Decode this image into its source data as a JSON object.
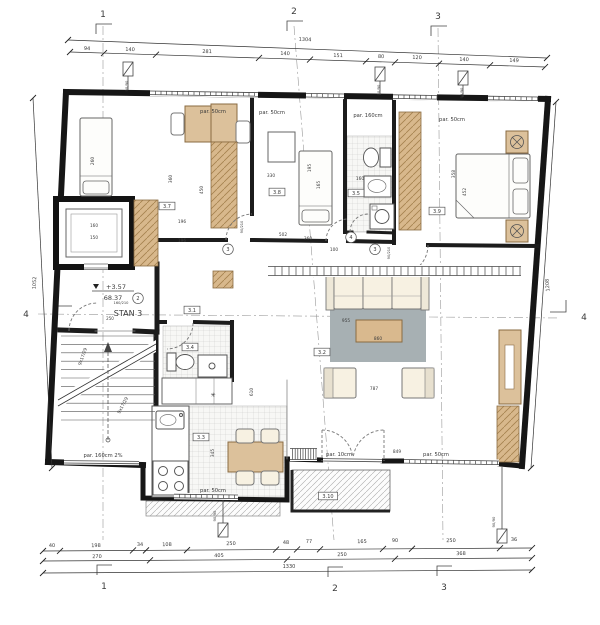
{
  "apartment": {
    "name": "STAN 3",
    "level": "+3.57",
    "area": "68.37"
  },
  "axes": {
    "top": [
      "1",
      "2",
      "3"
    ],
    "bottom": [
      "1",
      "2",
      "3"
    ],
    "left": "4",
    "right": "4"
  },
  "dimensions": {
    "top_total": "1304",
    "top_row": [
      "94",
      "140",
      "281",
      "140",
      "151",
      "80",
      "120",
      "140",
      "149"
    ],
    "bottom_row1": [
      "40",
      "198",
      "34",
      "108",
      "250",
      "48",
      "77",
      "165",
      "90",
      "250",
      "36"
    ],
    "bottom_row2": [
      "270",
      "405",
      "250",
      "368"
    ],
    "bottom_total": "1330",
    "left_total": "1052",
    "right_total": "1208"
  },
  "window_labels": [
    "par. 50cm",
    "par. 50cm",
    "par. 160cm",
    "par. 50cm",
    "par. 50cm",
    "par. 10cm",
    "par. 50cm",
    "par. 160cm 2%"
  ],
  "room_tags": [
    "3.1",
    "3.2",
    "3.3",
    "3.4",
    "3.5",
    "3.7",
    "3.8",
    "3.9",
    "3.10"
  ],
  "door_numbers": [
    "2",
    "3",
    "4",
    "3"
  ],
  "stair_label": "9x17/29",
  "labels": [
    {
      "n": "grid-axis-top-1",
      "t": "1",
      "x": 103,
      "y": 17,
      "s": 9,
      "c": "#222"
    },
    {
      "n": "grid-axis-top-2",
      "t": "2",
      "x": 294,
      "y": 14,
      "s": 9,
      "c": "#222"
    },
    {
      "n": "grid-axis-top-3",
      "t": "3",
      "x": 438,
      "y": 19,
      "s": 9,
      "c": "#222"
    },
    {
      "n": "grid-axis-bottom-1",
      "t": "1",
      "x": 104,
      "y": 589,
      "s": 9,
      "c": "#222"
    },
    {
      "n": "grid-axis-bottom-2",
      "t": "2",
      "x": 335,
      "y": 591,
      "s": 9,
      "c": "#222"
    },
    {
      "n": "grid-axis-bottom-3",
      "t": "3",
      "x": 444,
      "y": 590,
      "s": 9,
      "c": "#222"
    },
    {
      "n": "grid-axis-left-4",
      "t": "4",
      "x": 26,
      "y": 317,
      "s": 9,
      "c": "#222"
    },
    {
      "n": "grid-axis-right-4",
      "t": "4",
      "x": 584,
      "y": 320,
      "s": 9,
      "c": "#222"
    },
    {
      "n": "dim-top-total",
      "t": "1304",
      "x": 305,
      "y": 41,
      "r": 2
    },
    {
      "n": "dim-bottom-total",
      "t": "1330",
      "x": 289,
      "y": 568
    },
    {
      "n": "dim-left-total",
      "t": "1052",
      "x": 36,
      "y": 283,
      "r": -87
    },
    {
      "n": "dim-right-total",
      "t": "1208",
      "x": 549,
      "y": 285,
      "r": -94
    },
    {
      "n": "dim-top",
      "t": "94",
      "x": 87,
      "y": 50,
      "r": 2
    },
    {
      "n": "dim-top",
      "t": "140",
      "x": 130,
      "y": 51,
      "r": 2
    },
    {
      "n": "dim-top",
      "t": "281",
      "x": 207,
      "y": 53,
      "r": 2
    },
    {
      "n": "dim-top",
      "t": "140",
      "x": 285,
      "y": 55,
      "r": 2
    },
    {
      "n": "dim-top",
      "t": "151",
      "x": 338,
      "y": 57,
      "r": 2
    },
    {
      "n": "dim-top",
      "t": "80",
      "x": 381,
      "y": 58,
      "r": 2
    },
    {
      "n": "dim-top",
      "t": "120",
      "x": 417,
      "y": 59,
      "r": 2
    },
    {
      "n": "dim-top",
      "t": "140",
      "x": 464,
      "y": 61,
      "r": 2
    },
    {
      "n": "dim-top",
      "t": "149",
      "x": 514,
      "y": 62,
      "r": 2
    },
    {
      "n": "dim-bottom",
      "t": "40",
      "x": 52,
      "y": 547,
      "r": -1
    },
    {
      "n": "dim-bottom",
      "t": "198",
      "x": 96,
      "y": 547,
      "r": -1
    },
    {
      "n": "dim-bottom",
      "t": "34",
      "x": 140,
      "y": 546,
      "r": -1
    },
    {
      "n": "dim-bottom",
      "t": "108",
      "x": 167,
      "y": 546,
      "r": -1
    },
    {
      "n": "dim-bottom",
      "t": "250",
      "x": 231,
      "y": 545,
      "r": -1
    },
    {
      "n": "dim-bottom",
      "t": "48",
      "x": 286,
      "y": 544,
      "r": -1
    },
    {
      "n": "dim-bottom",
      "t": "77",
      "x": 309,
      "y": 543,
      "r": -1
    },
    {
      "n": "dim-bottom",
      "t": "165",
      "x": 362,
      "y": 543,
      "r": -1
    },
    {
      "n": "dim-bottom",
      "t": "90",
      "x": 395,
      "y": 542,
      "r": -1
    },
    {
      "n": "dim-bottom",
      "t": "250",
      "x": 451,
      "y": 542,
      "r": -1
    },
    {
      "n": "dim-bottom",
      "t": "36",
      "x": 514,
      "y": 541,
      "r": -1
    },
    {
      "n": "dim-bottom2",
      "t": "270",
      "x": 97,
      "y": 558,
      "r": -1
    },
    {
      "n": "dim-bottom2",
      "t": "405",
      "x": 219,
      "y": 557,
      "r": -1
    },
    {
      "n": "dim-bottom2",
      "t": "250",
      "x": 342,
      "y": 556,
      "r": -1
    },
    {
      "n": "dim-bottom2",
      "t": "368",
      "x": 461,
      "y": 555,
      "r": -1
    },
    {
      "n": "window-label",
      "t": "par. 50cm",
      "x": 213,
      "y": 113,
      "s": 5.2,
      "c": "#333"
    },
    {
      "n": "window-label",
      "t": "par. 50cm",
      "x": 272,
      "y": 114,
      "s": 5.2,
      "c": "#333"
    },
    {
      "n": "window-label",
      "t": "par. 160cm",
      "x": 368,
      "y": 117,
      "s": 5.2,
      "c": "#333"
    },
    {
      "n": "window-label",
      "t": "par. 50cm",
      "x": 452,
      "y": 121,
      "s": 5.2,
      "c": "#333"
    },
    {
      "n": "window-label",
      "t": "par. 50cm",
      "x": 213,
      "y": 492,
      "s": 5.2,
      "c": "#333"
    },
    {
      "n": "window-label",
      "t": "par. 10cm",
      "x": 339,
      "y": 456,
      "s": 5.2,
      "c": "#333"
    },
    {
      "n": "window-label",
      "t": "par. 50cm",
      "x": 436,
      "y": 456,
      "s": 5.2,
      "c": "#333"
    },
    {
      "n": "window-label",
      "t": "par. 160cm 2%",
      "x": 103,
      "y": 457,
      "s": 5.2,
      "c": "#333"
    },
    {
      "n": "room-tag",
      "t": "3.1",
      "x": 192,
      "y": 312,
      "box": 1
    },
    {
      "n": "room-tag",
      "t": "3.2",
      "x": 322,
      "y": 354,
      "box": 1
    },
    {
      "n": "room-tag",
      "t": "3.3",
      "x": 201,
      "y": 439,
      "box": 1
    },
    {
      "n": "room-tag",
      "t": "3.4",
      "x": 190,
      "y": 349,
      "box": 1
    },
    {
      "n": "room-tag",
      "t": "3.5",
      "x": 356,
      "y": 195,
      "box": 1
    },
    {
      "n": "room-tag",
      "t": "3.7",
      "x": 167,
      "y": 208,
      "box": 1
    },
    {
      "n": "room-tag",
      "t": "3.8",
      "x": 277,
      "y": 194,
      "box": 1
    },
    {
      "n": "room-tag",
      "t": "3.9",
      "x": 437,
      "y": 213,
      "box": 1
    },
    {
      "n": "room-tag",
      "t": "3.10",
      "x": 328,
      "y": 498,
      "box": 1
    },
    {
      "n": "door-number",
      "t": "2",
      "x": 138,
      "y": 300,
      "circ": 1
    },
    {
      "n": "door-number",
      "t": "3",
      "x": 228,
      "y": 251,
      "circ": 1
    },
    {
      "n": "door-number",
      "t": "4",
      "x": 351,
      "y": 239,
      "circ": 1
    },
    {
      "n": "door-number",
      "t": "3",
      "x": 375,
      "y": 251,
      "circ": 1
    },
    {
      "n": "stair-label",
      "t": "9x17/29",
      "x": 84,
      "y": 357,
      "r": -70,
      "s": 4.4
    },
    {
      "n": "stair-label",
      "t": "9x17/29",
      "x": 124,
      "y": 406,
      "r": -62,
      "s": 4.4
    },
    {
      "n": "elevator-dim",
      "t": "160",
      "x": 94,
      "y": 227,
      "s": 4.2
    },
    {
      "n": "elevator-dim",
      "t": "150",
      "x": 94,
      "y": 239,
      "s": 4.2
    },
    {
      "n": "dim-interior",
      "t": "260",
      "x": 94,
      "y": 161,
      "r": -90,
      "s": 4.3,
      "c": "#444"
    },
    {
      "n": "dim-interior",
      "t": "330",
      "x": 271,
      "y": 177,
      "s": 4.3,
      "c": "#444"
    },
    {
      "n": "dim-interior",
      "t": "196",
      "x": 182,
      "y": 223,
      "s": 4.3,
      "c": "#444"
    },
    {
      "n": "dim-interior",
      "t": "196",
      "x": 182,
      "y": 242,
      "s": 4.3,
      "c": "#444"
    },
    {
      "n": "dim-interior",
      "t": "360",
      "x": 172,
      "y": 179,
      "r": -90,
      "s": 4.3,
      "c": "#444"
    },
    {
      "n": "dim-interior",
      "t": "450",
      "x": 203,
      "y": 190,
      "r": -90,
      "s": 4.3,
      "c": "#444"
    },
    {
      "n": "dim-interior",
      "t": "195",
      "x": 311,
      "y": 168,
      "r": -90,
      "s": 4.3,
      "c": "#444"
    },
    {
      "n": "dim-interior",
      "t": "165",
      "x": 320,
      "y": 185,
      "r": -90,
      "s": 4.3,
      "c": "#444"
    },
    {
      "n": "dim-interior",
      "t": "358",
      "x": 455,
      "y": 174,
      "r": -90,
      "s": 4.3,
      "c": "#444"
    },
    {
      "n": "dim-interior",
      "t": "452",
      "x": 466,
      "y": 192,
      "r": -90,
      "s": 4.3,
      "c": "#444"
    },
    {
      "n": "dim-interior",
      "t": "502",
      "x": 283,
      "y": 236,
      "s": 4.3,
      "c": "#444"
    },
    {
      "n": "dim-interior",
      "t": "360",
      "x": 308,
      "y": 240,
      "s": 4.3,
      "c": "#444"
    },
    {
      "n": "dim-interior",
      "t": "100",
      "x": 334,
      "y": 251,
      "s": 4.3,
      "c": "#444"
    },
    {
      "n": "dim-interior",
      "t": "955",
      "x": 346,
      "y": 322,
      "s": 4.3,
      "c": "#444"
    },
    {
      "n": "dim-interior",
      "t": "860",
      "x": 378,
      "y": 340,
      "s": 4.3,
      "c": "#444"
    },
    {
      "n": "dim-interior",
      "t": "787",
      "x": 374,
      "y": 390,
      "s": 4.3,
      "c": "#444"
    },
    {
      "n": "dim-interior",
      "t": "610",
      "x": 253,
      "y": 392,
      "r": -90,
      "s": 4.3,
      "c": "#444"
    },
    {
      "n": "dim-interior",
      "t": "849",
      "x": 397,
      "y": 453,
      "s": 4.3,
      "c": "#444"
    },
    {
      "n": "dim-interior",
      "t": "345",
      "x": 214,
      "y": 453,
      "r": -90,
      "s": 4.3,
      "c": "#444"
    },
    {
      "n": "dim-interior",
      "t": "160",
      "x": 360,
      "y": 180,
      "s": 4.3,
      "c": "#444"
    },
    {
      "n": "dim-interior",
      "t": "250",
      "x": 110,
      "y": 320,
      "s": 4,
      "c": "#444"
    },
    {
      "n": "door-size",
      "t": "160/210",
      "x": 121,
      "y": 304,
      "s": 3.6,
      "c": "#555"
    },
    {
      "n": "door-size",
      "t": "90/210",
      "x": 243,
      "y": 227,
      "r": -90,
      "s": 3.6,
      "c": "#555"
    },
    {
      "n": "door-size",
      "t": "90/210",
      "x": 390,
      "y": 253,
      "r": -90,
      "s": 3.6,
      "c": "#555"
    },
    {
      "n": "window-size",
      "t": "90/90",
      "x": 128,
      "y": 86,
      "r": -90,
      "s": 3.8,
      "c": "#444"
    },
    {
      "n": "window-size",
      "t": "90/90",
      "x": 380,
      "y": 90,
      "r": -90,
      "s": 3.8,
      "c": "#444"
    },
    {
      "n": "window-size",
      "t": "90/90",
      "x": 463,
      "y": 93,
      "r": -90,
      "s": 3.8,
      "c": "#444"
    },
    {
      "n": "window-size",
      "t": "90/90",
      "x": 216,
      "y": 516,
      "r": -90,
      "s": 3.8,
      "c": "#444"
    },
    {
      "n": "window-size",
      "t": "90/90",
      "x": 495,
      "y": 522,
      "r": -90,
      "s": 3.8,
      "c": "#444"
    },
    {
      "n": "freezer-icon",
      "t": "✳",
      "x": 213,
      "y": 397,
      "s": 6,
      "c": "#333"
    }
  ]
}
